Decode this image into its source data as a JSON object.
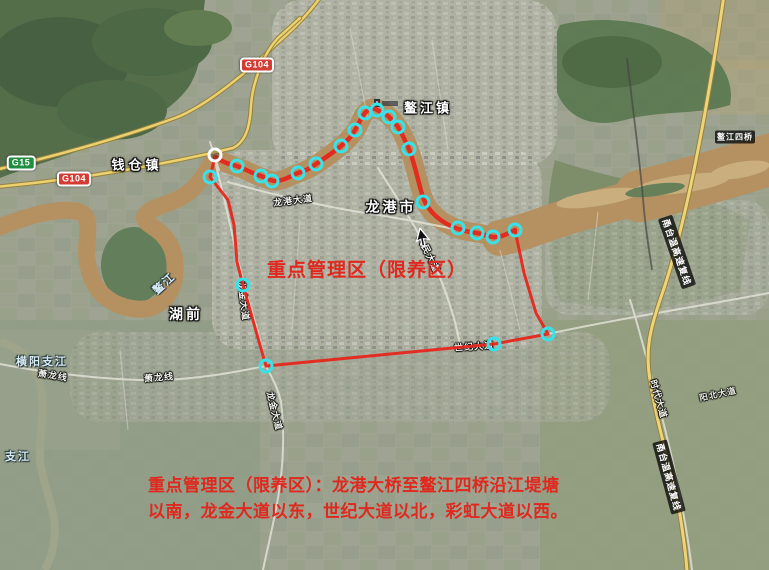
{
  "map": {
    "annotation_color": "#e0281e",
    "boundary_color": "#e8231a",
    "marker_color": "#38e2ea",
    "start_marker_color": "#ffffff",
    "zone_label": "重点管理区（限养区）",
    "note_line1": "重点管理区（限养区）：龙港大桥至鳌江四桥沿江堤塘",
    "note_line2": "以南，龙金大道以东，世纪大道以北，彩虹大道以西。",
    "shields": {
      "g15": "G15",
      "g104_west": "G104",
      "g104_north": "G104"
    },
    "places": {
      "qiancang": "钱仓镇",
      "aojiang": "鳌江镇",
      "longgang": "龙港市",
      "huqian": "湖前"
    },
    "waters": {
      "hengyang": "横阳支江",
      "zhijiang": "支江",
      "aojiang_river": "鳌江"
    },
    "roads": {
      "longgang_ave": "龙港大道",
      "renmin_ave": "人民大道",
      "shiji_ave": "世纪大道",
      "xiaolong_w": "萧龙线",
      "xiaolong_e": "萧龙线",
      "longjin_n": "龙金大道",
      "longjin_s": "龙金大道",
      "shidai_ave": "时代大道",
      "yangbei_ave": "阳北大道",
      "expressway_n": "甬台温高速复线",
      "expressway_s": "甬台温高速复线",
      "bridge4": "鳌江四桥"
    }
  }
}
